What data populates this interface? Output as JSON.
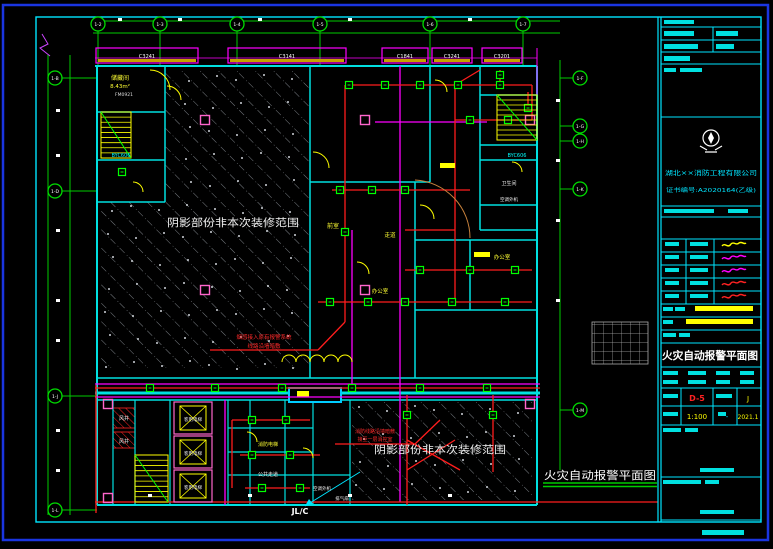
{
  "sheet": {
    "type": "CAD fire-alarm floor plan",
    "border_color": "#1a35e0",
    "frame_color": "#00e5ff",
    "background": "#000000"
  },
  "titleblock": {
    "title": "火灾自动报警平面图",
    "company": "湖北××消防工程有限公司",
    "cert": "证书编号:A2020164(乙级)",
    "drawing_no": "D-5",
    "scale": "1:100",
    "category": "J",
    "date": "2021.1",
    "dash": "-",
    "signature_colors": [
      "#ffff00",
      "#ff00ff",
      "#ff00ff",
      "#ff2222",
      "#ff2222"
    ]
  },
  "plan": {
    "bottom_title": "火灾自动报警平面图",
    "shaded_note_a": "阴影部份非本次装修范围",
    "shaded_note_b": "阴影部份非本次装修范围",
    "windows": [
      {
        "x": 96,
        "w": 102,
        "label": "C3241"
      },
      {
        "x": 228,
        "w": 118,
        "label": "C3141"
      },
      {
        "x": 382,
        "w": 46,
        "label": "C1841"
      },
      {
        "x": 432,
        "w": 40,
        "label": "C3241"
      },
      {
        "x": 482,
        "w": 40,
        "label": "C3201"
      }
    ],
    "axis_bubbles": {
      "top": [
        {
          "x": 98,
          "label": "1-2"
        },
        {
          "x": 160,
          "label": "1-3"
        },
        {
          "x": 237,
          "label": "1-4"
        },
        {
          "x": 320,
          "label": "1-5"
        },
        {
          "x": 430,
          "label": "1-6"
        },
        {
          "x": 523,
          "label": "1-7"
        }
      ],
      "left": [
        {
          "y": 78,
          "label": "1-B"
        },
        {
          "y": 191,
          "label": "1-D"
        },
        {
          "y": 396,
          "label": "1-J"
        },
        {
          "y": 510,
          "label": "1-L"
        }
      ],
      "right": [
        {
          "y": 78,
          "label": "1-F"
        },
        {
          "y": 126,
          "label": "1-G"
        },
        {
          "y": 141,
          "label": "1-H"
        },
        {
          "y": 189,
          "label": "1-K"
        },
        {
          "y": 410,
          "label": "1-M"
        }
      ]
    },
    "columns": [
      [
        205,
        120
      ],
      [
        365,
        120
      ],
      [
        205,
        290
      ],
      [
        365,
        290
      ],
      [
        108,
        404
      ],
      [
        108,
        498
      ],
      [
        530,
        404
      ],
      [
        530,
        120
      ]
    ],
    "detectors": [
      [
        349,
        85
      ],
      [
        385,
        85
      ],
      [
        420,
        85
      ],
      [
        458,
        85
      ],
      [
        500,
        85
      ],
      [
        470,
        120
      ],
      [
        508,
        120
      ],
      [
        340,
        190
      ],
      [
        372,
        190
      ],
      [
        405,
        190
      ],
      [
        420,
        270
      ],
      [
        470,
        270
      ],
      [
        515,
        270
      ],
      [
        330,
        302
      ],
      [
        368,
        302
      ],
      [
        405,
        302
      ],
      [
        452,
        302
      ],
      [
        505,
        302
      ],
      [
        150,
        388
      ],
      [
        215,
        388
      ],
      [
        282,
        388
      ],
      [
        352,
        388
      ],
      [
        420,
        388
      ],
      [
        487,
        388
      ],
      [
        252,
        420
      ],
      [
        286,
        420
      ],
      [
        252,
        455
      ],
      [
        290,
        455
      ],
      [
        262,
        488
      ],
      [
        300,
        488
      ],
      [
        122,
        172
      ],
      [
        500,
        75
      ],
      [
        528,
        108
      ],
      [
        345,
        232
      ],
      [
        407,
        415
      ],
      [
        493,
        415
      ]
    ],
    "stairs": [
      {
        "x": 101,
        "y": 112,
        "w": 30,
        "h": 46,
        "n": 9
      },
      {
        "x": 497,
        "y": 95,
        "w": 40,
        "h": 45,
        "n": 9
      },
      {
        "x": 135,
        "y": 455,
        "w": 33,
        "h": 47,
        "n": 9
      }
    ],
    "elevators": [
      {
        "x": 174,
        "y": 402
      },
      {
        "x": 174,
        "y": 436
      },
      {
        "x": 174,
        "y": 470
      }
    ],
    "ticks": {
      "top": [
        [
          120,
          19
        ],
        [
          180,
          19
        ],
        [
          260,
          19
        ],
        [
          350,
          19
        ],
        [
          470,
          19
        ]
      ],
      "left": [
        [
          58,
          110
        ],
        [
          58,
          155
        ],
        [
          58,
          230
        ],
        [
          58,
          300
        ],
        [
          58,
          340
        ],
        [
          58,
          430
        ],
        [
          58,
          470
        ]
      ],
      "right": [
        [
          558,
          100
        ],
        [
          558,
          160
        ],
        [
          558,
          220
        ],
        [
          558,
          300
        ]
      ],
      "bottom": [
        [
          150,
          495
        ],
        [
          250,
          495
        ],
        [
          350,
          495
        ],
        [
          450,
          495
        ]
      ]
    },
    "labels": [
      {
        "t": "储藏间",
        "x": 120,
        "y": 80,
        "c": "#ffff33",
        "s": 6
      },
      {
        "t": "8.43m²",
        "x": 120,
        "y": 88,
        "c": "#ffff33",
        "s": 5.5
      },
      {
        "t": "FM0921",
        "x": 124,
        "y": 96,
        "c": "#dddddd",
        "s": 4.5
      },
      {
        "t": "BYC606",
        "x": 121,
        "y": 157,
        "c": "#00ffff",
        "s": 5
      },
      {
        "t": "BYC606",
        "x": 517,
        "y": 157,
        "c": "#00ffff",
        "s": 5
      },
      {
        "t": "卫生间",
        "x": 509,
        "y": 185,
        "c": "#eeeeee",
        "s": 5
      },
      {
        "t": "空调外机",
        "x": 509,
        "y": 201,
        "c": "#eeeeee",
        "s": 4.5
      },
      {
        "t": "前室",
        "x": 333,
        "y": 228,
        "c": "#ffff33",
        "s": 6
      },
      {
        "t": "走道",
        "x": 390,
        "y": 237,
        "c": "#ffff33",
        "s": 5.5
      },
      {
        "t": "办公室",
        "x": 380,
        "y": 293,
        "c": "#ffff33",
        "s": 5.5
      },
      {
        "t": "办公室",
        "x": 502,
        "y": 259,
        "c": "#ffff33",
        "s": 5.5
      },
      {
        "t": "风井",
        "x": 124,
        "y": 420,
        "c": "#eeeeee",
        "s": 5
      },
      {
        "t": "风井",
        "x": 124,
        "y": 443,
        "c": "#eeeeee",
        "s": 5
      },
      {
        "t": "客用电梯",
        "x": 193,
        "y": 421,
        "c": "#eeeeee",
        "s": 4.5
      },
      {
        "t": "客用电梯",
        "x": 193,
        "y": 455,
        "c": "#eeeeee",
        "s": 4.5
      },
      {
        "t": "客用电梯",
        "x": 193,
        "y": 489,
        "c": "#eeeeee",
        "s": 4.5
      },
      {
        "t": "消防电梯",
        "x": 268,
        "y": 446,
        "c": "#ffff33",
        "s": 5
      },
      {
        "t": "公共走道",
        "x": 268,
        "y": 476,
        "c": "#eeeeee",
        "s": 5
      },
      {
        "t": "空调外机",
        "x": 322,
        "y": 490,
        "c": "#eeeeee",
        "s": 4.5
      },
      {
        "t": "排气扇",
        "x": 342,
        "y": 500,
        "c": "#eeeeee",
        "s": 4.5
      },
      {
        "t": "JL/C",
        "x": 300,
        "y": 514,
        "c": "#ffffff",
        "s": 8,
        "b": 1
      },
      {
        "t": "烟感接入原有报警系统",
        "x": 264,
        "y": 339,
        "c": "#ff2a2a",
        "s": 5.5
      },
      {
        "t": "线路沿墙暗敷",
        "x": 264,
        "y": 348,
        "c": "#ff2a2a",
        "s": 5.5
      },
      {
        "t": "消防线路沿墙暗敷",
        "x": 375,
        "y": 433,
        "c": "#ff2a2a",
        "s": 5
      },
      {
        "t": "接至一层消控室",
        "x": 375,
        "y": 441,
        "c": "#ff2a2a",
        "s": 5
      }
    ]
  }
}
